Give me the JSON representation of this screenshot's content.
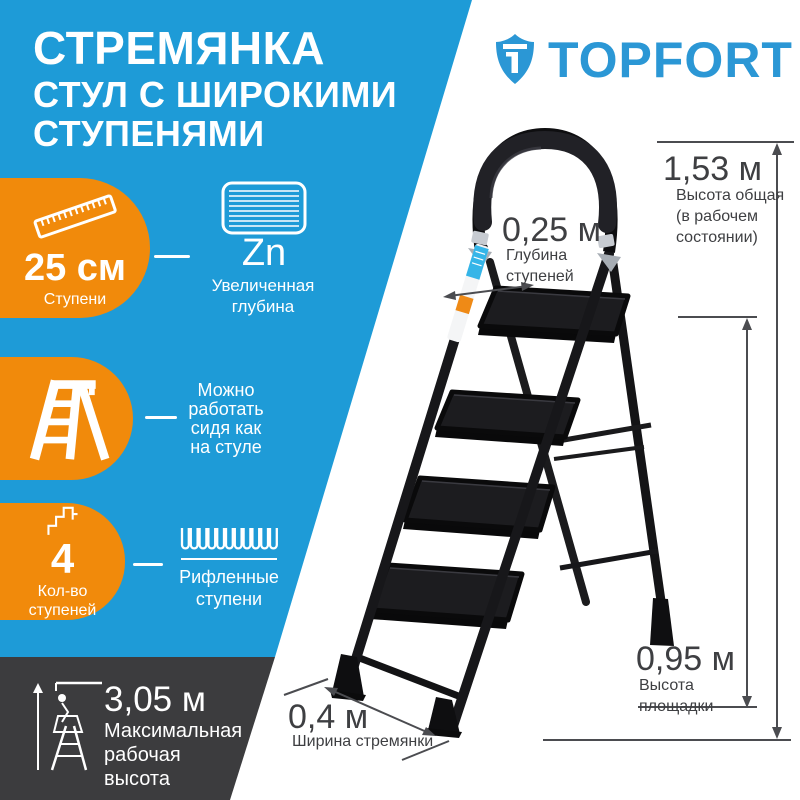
{
  "brand": {
    "name": "TOPFORT"
  },
  "title": {
    "lines": [
      "СТРЕМЯНКА",
      "СТУЛ С ШИРОКИМИ",
      "СТУПЕНЯМИ"
    ]
  },
  "features": {
    "steps_width": {
      "value": "25 см",
      "label": "Ступени"
    },
    "zn": {
      "symbol": "Zn",
      "label_lines": [
        "Увеличенная",
        "глубина"
      ]
    },
    "chair": {
      "lines": [
        "Можно",
        "работать",
        "сидя как",
        "на стуле"
      ]
    },
    "steps_count": {
      "value": "4",
      "label_lines": [
        "Кол-во",
        "ступеней"
      ]
    },
    "ribbed": {
      "label_lines": [
        "Рифленные",
        "ступени"
      ]
    },
    "working_height": {
      "value": "3,05 м",
      "label_lines": [
        "Максимальная",
        "рабочая",
        "высота"
      ]
    }
  },
  "dimensions": {
    "step_depth": {
      "value": "0,25 м",
      "label_lines": [
        "Глубина",
        "ступеней"
      ]
    },
    "total_height": {
      "value": "1,53 м",
      "label_lines": [
        "Высота общая",
        "(в рабочем",
        "состоянии)"
      ]
    },
    "platform_height": {
      "value": "0,95 м",
      "label_lines": [
        "Высота",
        "площадки"
      ]
    },
    "width": {
      "value": "0,4 м",
      "label": "Ширина стремянки"
    }
  },
  "colors": {
    "blue": "#1E9BD7",
    "orange": "#F18A0B",
    "dark_panel": "#3C3C3E",
    "logo_blue": "#2B97D5",
    "annotation": "#4B4C50",
    "ladder_black": "#17171A",
    "sticker_cyan": "#35B5E8",
    "sticker_orange": "#EF8A16"
  }
}
